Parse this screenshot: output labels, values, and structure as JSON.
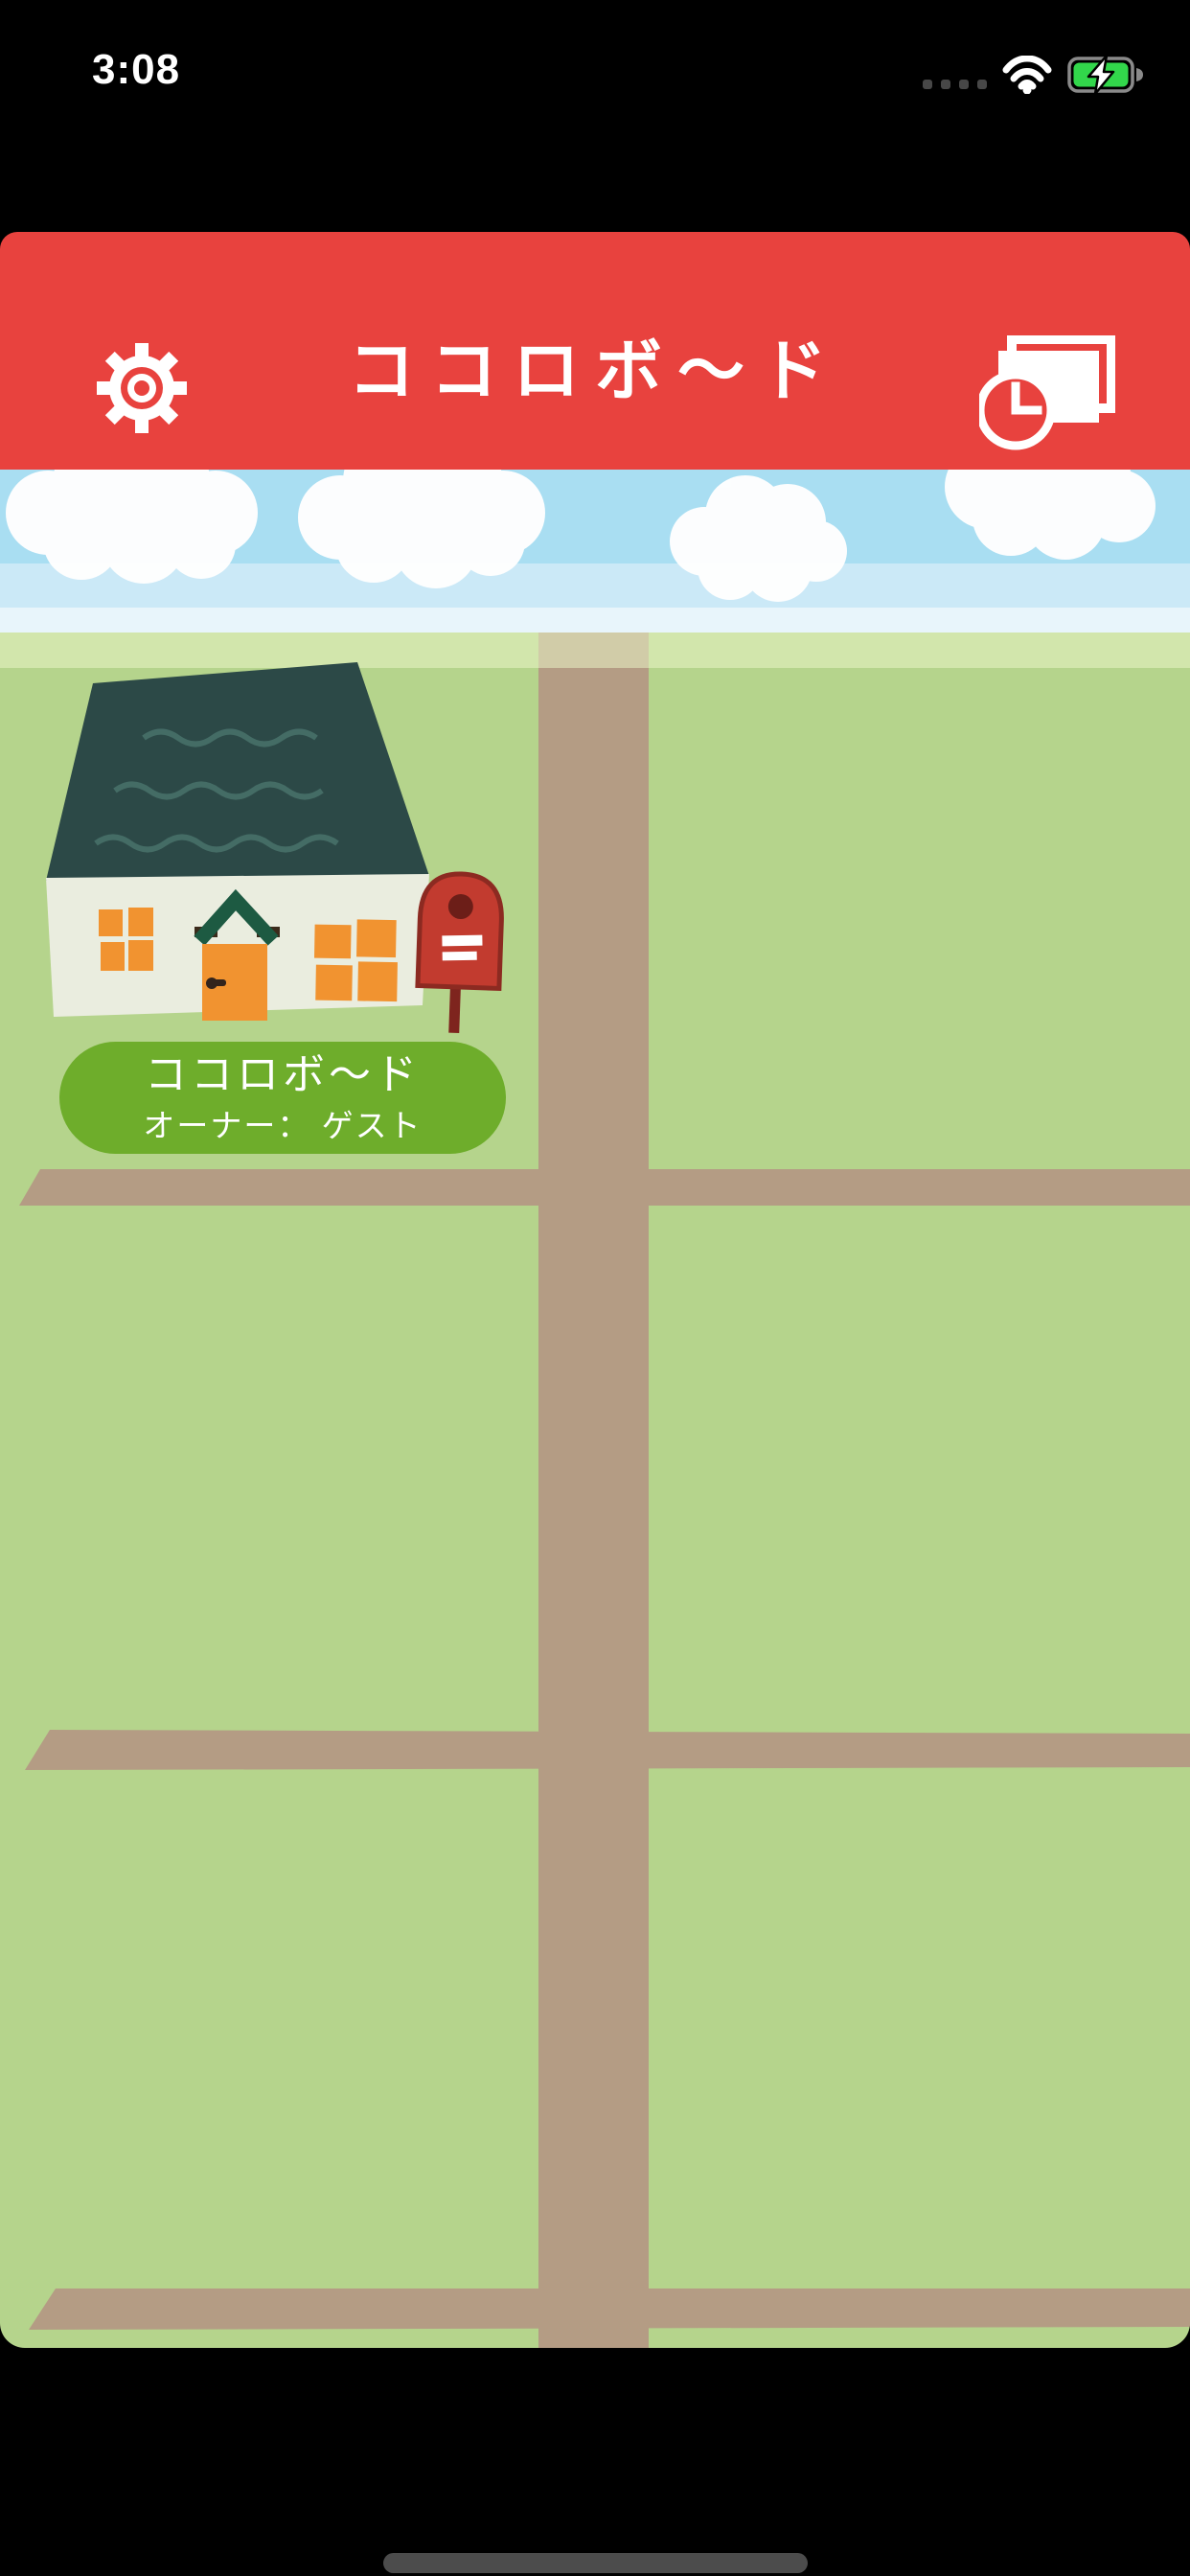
{
  "status_bar": {
    "time": "3:08",
    "icons": [
      "cellular-dots-icon",
      "wifi-icon",
      "battery-charging-icon"
    ]
  },
  "header": {
    "title": "ココロボ〜ド",
    "left_icon": "gear-icon",
    "right_icon": "recent-boards-clock-icon"
  },
  "map": {
    "house_label": {
      "title": "ココロボ〜ド",
      "owner": "オーナー： ゲスト"
    },
    "scene_icons": [
      "house-icon",
      "mailbox-icon",
      "cloud-icon",
      "road-shape"
    ]
  },
  "colors": {
    "header_red": "#e8423e",
    "sky_blue": "#a9def2",
    "sky_band2": "#cbe9f7",
    "sky_band3": "#e8f5fb",
    "field_green": "#b5d48c",
    "field_light_band": "#cde4a6",
    "road_tan": "#b49c84",
    "label_green": "#6ead2b",
    "roof_teal": "#2c4947",
    "house_wall": "#eaeddf",
    "house_orange": "#f19330",
    "mailbox_red": "#c23b2f",
    "battery_green": "#32d74b",
    "home_indicator_gray": "#4c4c4c"
  }
}
